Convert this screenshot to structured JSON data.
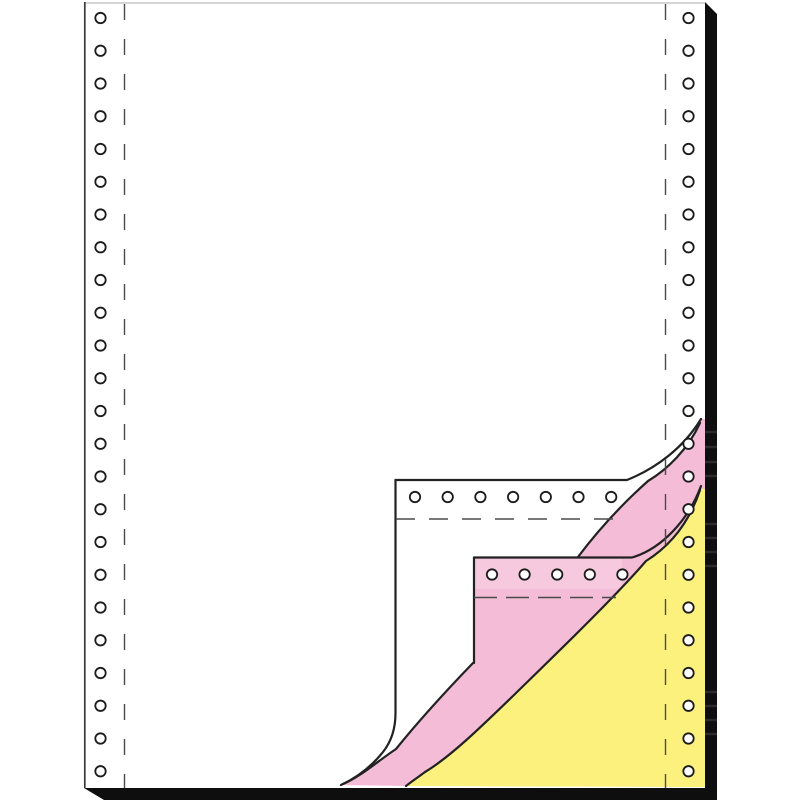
{
  "meta": {
    "image_type": "product-photo",
    "subject": "3-ply continuous form paper, corner peeled to show white, pink and yellow carbonless copy sheets"
  },
  "colors": {
    "top-sheet": "#ffffff",
    "copy-pink": "#f5bcd7",
    "copy-pink-light": "#f9d2e4",
    "copy-yellow": "#fbf17c",
    "outline": "#222222",
    "shadow": "#0e0e0e",
    "edge-line": "#3a3a3a",
    "perforation": "#4a4a4a",
    "hole-stroke": "#1c1c1c",
    "hole-fill": "#ffffff",
    "sheet-top-edge": "#bdbdbd"
  },
  "sprocket_holes": {
    "radius": 5.2,
    "columns": [
      {
        "name": "left-column",
        "cx": 100.5,
        "first_cy": 18,
        "spacing": 32.75,
        "count": 24
      },
      {
        "name": "right-column",
        "cx": 688.5,
        "first_cy": 18,
        "spacing": 32.75,
        "count": 24
      }
    ],
    "rows": [
      {
        "name": "white-flap-row",
        "cy": 497,
        "first_cx": 415,
        "spacing": 32.7,
        "count": 7
      },
      {
        "name": "pink-flap-row",
        "cy": 574.5,
        "first_cx": 492,
        "spacing": 32.6,
        "count": 5
      }
    ]
  },
  "perforation_lines": {
    "left_x": 124.5,
    "right_x": 665.5,
    "white_flap_y": 519,
    "pink_flap_y": 597.5
  },
  "plies": [
    {
      "position": 1,
      "color_name": "white"
    },
    {
      "position": 2,
      "color_name": "pink"
    },
    {
      "position": 3,
      "color_name": "yellow"
    }
  ]
}
